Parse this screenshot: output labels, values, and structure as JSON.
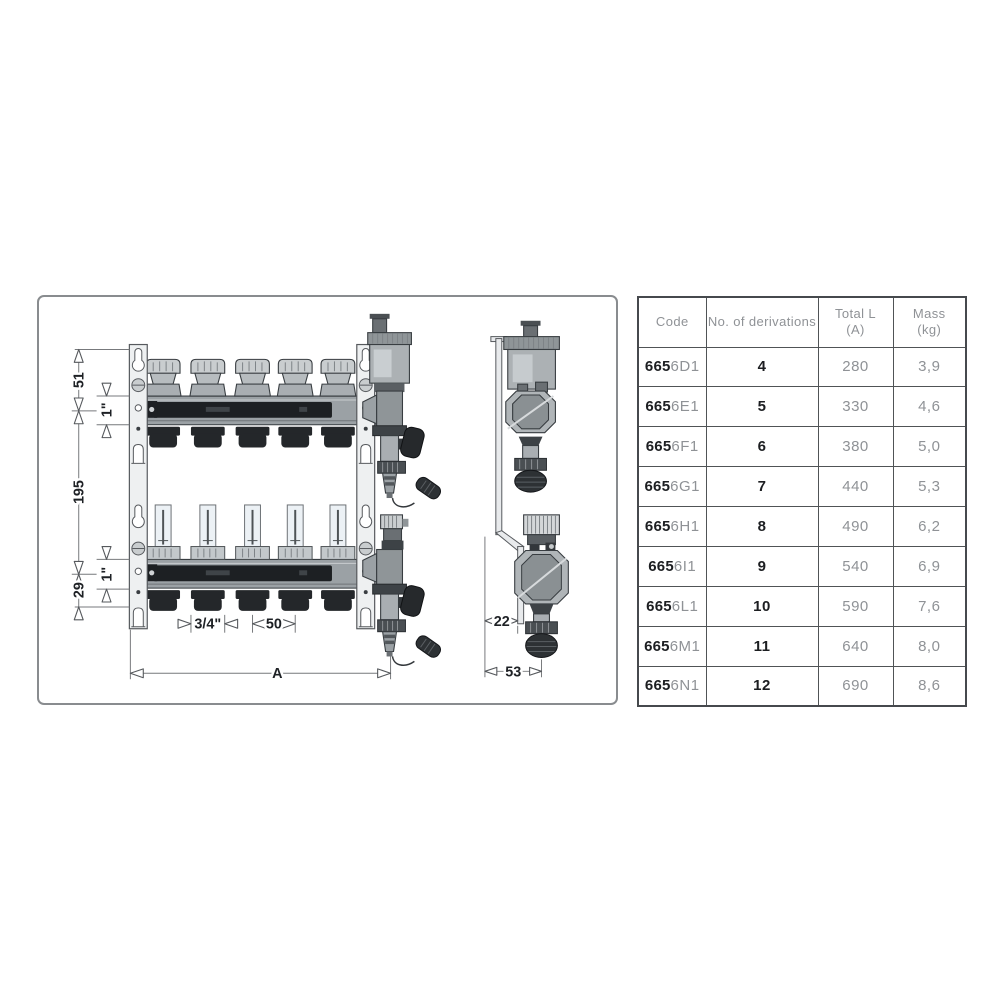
{
  "drawing": {
    "front_view": {
      "dims": {
        "bracket_top_to_axis": "51",
        "top_manifold_size": "1\"",
        "axis_spacing": "195",
        "axis_to_base": "29",
        "bottom_manifold_size": "1\"",
        "outlet_size": "3/4\"",
        "outlet_pitch": "50",
        "total_length": "A"
      }
    },
    "side_view": {
      "dims": {
        "bracket_offset": "22",
        "depth": "53"
      }
    }
  },
  "table": {
    "headers": [
      {
        "label": "Code"
      },
      {
        "label": "No. of derivations"
      },
      {
        "line1": "Total L",
        "line2": "(A)"
      },
      {
        "line1": "Mass",
        "line2": "(kg)"
      }
    ],
    "rows": [
      {
        "code_bold": "665",
        "code_suffix": "6D1",
        "derivations": "4",
        "total_l": "280",
        "mass": "3,9"
      },
      {
        "code_bold": "665",
        "code_suffix": "6E1",
        "derivations": "5",
        "total_l": "330",
        "mass": "4,6"
      },
      {
        "code_bold": "665",
        "code_suffix": "6F1",
        "derivations": "6",
        "total_l": "380",
        "mass": "5,0"
      },
      {
        "code_bold": "665",
        "code_suffix": "6G1",
        "derivations": "7",
        "total_l": "440",
        "mass": "5,3"
      },
      {
        "code_bold": "665",
        "code_suffix": "6H1",
        "derivations": "8",
        "total_l": "490",
        "mass": "6,2"
      },
      {
        "code_bold": "665",
        "code_suffix": "6I1",
        "derivations": "9",
        "total_l": "540",
        "mass": "6,9"
      },
      {
        "code_bold": "665",
        "code_suffix": "6L1",
        "derivations": "10",
        "total_l": "590",
        "mass": "7,6"
      },
      {
        "code_bold": "665",
        "code_suffix": "6M1",
        "derivations": "11",
        "total_l": "640",
        "mass": "8,0"
      },
      {
        "code_bold": "665",
        "code_suffix": "6N1",
        "derivations": "12",
        "total_l": "690",
        "mass": "8,6"
      }
    ]
  },
  "colors": {
    "panel_border": "#898c8f",
    "table_border": "#46494d",
    "muted_text": "#8f9296",
    "strong_text": "#1c1e21",
    "drawing_outline": "#383d41",
    "dark_fitting": "#26292c"
  }
}
